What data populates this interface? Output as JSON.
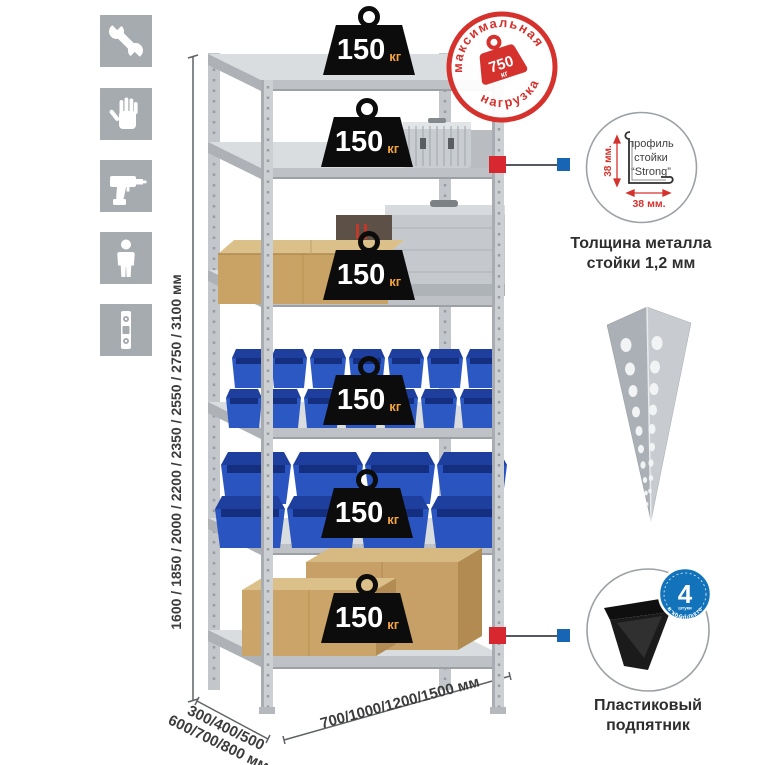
{
  "stamp": {
    "arc_top": "максимальная",
    "arc_bottom": "нагрузка",
    "value": "750",
    "unit": "кг"
  },
  "weights": [
    {
      "value": "150",
      "unit": "кг"
    },
    {
      "value": "150",
      "unit": "кг"
    },
    {
      "value": "150",
      "unit": "кг"
    },
    {
      "value": "150",
      "unit": "кг"
    },
    {
      "value": "150",
      "unit": "кг"
    },
    {
      "value": "150",
      "unit": "кг"
    }
  ],
  "dimensions": {
    "height": "1600 / 1850 / 2000 / 2200 / 2350 / 2550 / 2750 / 3100 мм",
    "depth_line1": "300/400/500",
    "depth_line2": "600/700/800 мм",
    "width": "700/1000/1200/1500 мм"
  },
  "profile_detail": {
    "line1": "профиль",
    "line2": "стойки",
    "line3": "“Strong”",
    "dim_vertical": "38 мм.",
    "dim_horizontal": "38 мм.",
    "caption_line1": "Толщина металла",
    "caption_line2": "стойки 1,2 мм"
  },
  "foot_detail": {
    "badge_value": "4",
    "badge_sub": "штуки",
    "badge_arc": "в комплекте",
    "caption_line1": "Пластиковый",
    "caption_line2": "подпятник"
  },
  "icons": [
    {
      "name": "wrench-icon"
    },
    {
      "name": "gloves-icon"
    },
    {
      "name": "drill-icon"
    },
    {
      "name": "person-icon"
    },
    {
      "name": "level-icon"
    }
  ],
  "colors": {
    "accent_red": "#d5322d",
    "accent_blue": "#1273bb",
    "icon_bg": "#a6abb0",
    "bin_blue": "#2c58c4",
    "weight_black": "#0d0d0d",
    "kg_orange": "#f2a33c",
    "metal_gray": "#c9cdd1",
    "cardboard": "#c8a36a"
  }
}
